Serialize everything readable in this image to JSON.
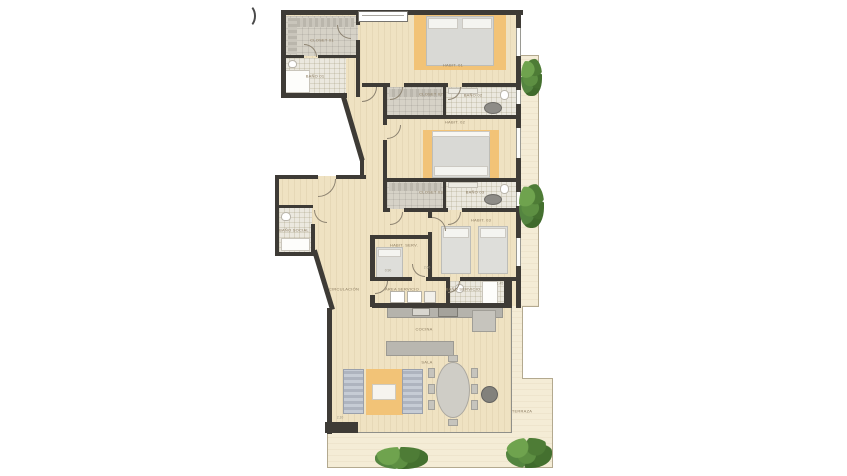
{
  "plan": {
    "title": "apartment-floor-plan",
    "rooms": [
      {
        "label": "CLOSET 01"
      },
      {
        "label": "BAÑO 01"
      },
      {
        "label": "HABIT. 01"
      },
      {
        "label": "CLOSET 02"
      },
      {
        "label": "BAÑO 02"
      },
      {
        "label": "HABIT. 02"
      },
      {
        "label": "CLOSET 03"
      },
      {
        "label": "BAÑO 03"
      },
      {
        "label": "HABIT. 03"
      },
      {
        "label": "HABIT. SERV."
      },
      {
        "label": "BAÑO SOCIAL"
      },
      {
        "label": "CIRCULACIÓN"
      },
      {
        "label": "ÁREA SERVICIO"
      },
      {
        "label": "BAÑO SERVICIO"
      },
      {
        "label": "COCINA"
      },
      {
        "label": "SALA"
      },
      {
        "label": "TERRAZA"
      }
    ],
    "dims": [
      {
        "t": "2.10"
      },
      {
        "t": "1.45"
      },
      {
        "t": "2.60"
      },
      {
        "t": "0.90"
      }
    ],
    "colors": {
      "wall": "#3e3b36",
      "wood_floor": "#efe2c2",
      "terrace_floor": "#f4ecd6",
      "accent_rug": "#f2c377",
      "plant_green": "#5d8f42",
      "label_text": "#8a7a5e"
    }
  }
}
